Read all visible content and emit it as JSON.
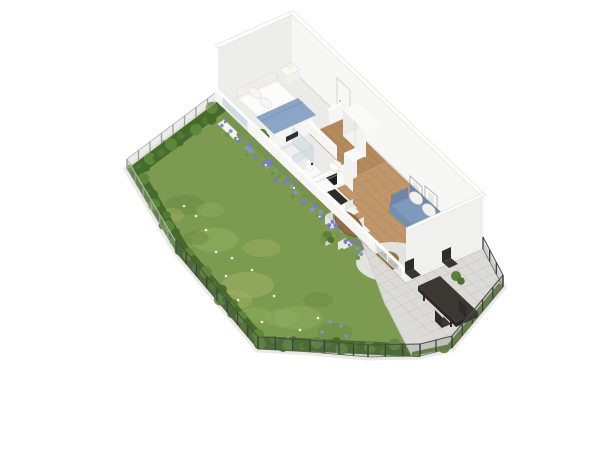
{
  "canvas": {
    "width": 600,
    "height": 450
  },
  "scene": {
    "description": "3D isometric floor plan render of a one-bedroom garden apartment with terrace",
    "areas": {
      "garden": {
        "items": [
          "lawn",
          "hedge",
          "wire-fence",
          "lavender-flowers",
          "daisies"
        ]
      },
      "bedroom": {
        "items": [
          "double-bed",
          "blue-blanket",
          "pillows",
          "nightstand",
          "plant",
          "window"
        ]
      },
      "hallway": {
        "items": [
          "entry-door",
          "wardrobe",
          "wood-floor"
        ]
      },
      "bathroom": {
        "items": [
          "shower",
          "vanity-sink",
          "toilet",
          "mirror"
        ]
      },
      "kitchen": {
        "items": [
          "l-shaped-counter",
          "oven",
          "cooktop",
          "tall-cabinet",
          "plant"
        ]
      },
      "living_room": {
        "items": [
          "round-dining-table",
          "four-chairs",
          "blue-sofa",
          "coffee-table",
          "rug",
          "two-wall-frames",
          "terrace-door"
        ]
      },
      "terrace": {
        "items": [
          "stone-tiles",
          "dark-dining-table",
          "four-chairs",
          "mesh-fence",
          "grass-strip"
        ]
      }
    },
    "counts": {
      "interior_chairs": 4,
      "terrace_chairs": 4,
      "wall_frames": 2,
      "pillows": 2
    }
  },
  "palette": {
    "bg": "#ffffff",
    "edging": "#e9e7e2",
    "edging2": "#f1efeb",
    "grass": "#7c9b50",
    "grassLight": "#8fae5f",
    "grassDark": "#6a8a41",
    "grassYellow": "#a3b264",
    "hedgeDark": "#466b2b",
    "hedgeMid": "#527a33",
    "hedgeLight": "#5f8a3c",
    "daisy": "#f6f6f2",
    "violet": "#8a8fd6",
    "lavender": "#7b79cf",
    "fencePostLight": "#9aa09b",
    "fenceRailLight": "#b8bdb8",
    "meshLight": "rgba(185,190,184,0.28)",
    "fencePostDark": "#3d423c",
    "fenceRailDark": "#4a4f48",
    "meshDark": "rgba(100,110,96,0.22)",
    "wallBright": "#f7f7f5",
    "wallTop": "#fdfdfc",
    "wallSide": "#ededeb",
    "wallNear": "#f5f5f3",
    "wallRight": "#f0f0ee",
    "wallStroke": "#e3e3df",
    "wallShadow": "rgba(90,90,85,0.12)",
    "innerShadow": "rgba(100,100,95,0.15)",
    "floorBedroom": "#ebebe9",
    "floorBath": "#e9eae9",
    "wood": "#b28a5c",
    "woodLine": "#9d7a4e",
    "parquet": "#c0976a",
    "doorWhite": "#f7f7f5",
    "doorStroke": "#d5d5d1",
    "glass": "#ccd6dc",
    "frame": "#fdfdfc",
    "frameStroke": "#b5b5b1",
    "frameInner": "#e8e8e4",
    "bedFrame": "#f7f7f4",
    "bedStroke": "#e2e2de",
    "mattress": "#fcfcfa",
    "headboard": "#efeeeb",
    "pillow": "#f6f6f2",
    "pillowStroke": "#e3e3de",
    "blanket": "#8ba5c6",
    "blanketLine": "#7b97bb",
    "furnWhite": "#f8f8f5",
    "furnFace": "#ededea",
    "furnSide": "#f1f1ee",
    "furnStroke": "#e4e4df",
    "wardrobeFront": "#f3f3f0",
    "wardrobeSide": "#eaeae7",
    "wardrobeTop": "#fafaf8",
    "lineGrey": "#dcdcd8",
    "counter": "#f9f9f7",
    "counterSide": "#ededea",
    "counterFront": "#f2f2ef",
    "black": "#1f1f1f",
    "cooktop": "#2b2b2b",
    "steel": "#6a6a6a",
    "mirror": "#2e2e2e",
    "showerGlass": "rgba(205,218,226,0.5)",
    "showerRim": "#cfd6da",
    "trayFill": "#eef0f0",
    "trayStroke": "#d7dada",
    "toiletWhite": "#fbfbf9",
    "tableWood": "#996f45",
    "tableWoodDark": "#7d5a36",
    "chairWhite": "#f3f2ee",
    "chairShade": "#e9e7e2",
    "chairStroke": "#deddd8",
    "rug": "#e2e2de",
    "sofaBack": "#6d87aa",
    "sofaSeat": "#7f99bc",
    "sofaFront": "#7390b3",
    "cushion": "#f2f1ed",
    "cushionStroke": "#e0dfda",
    "throw": "#e8e7e2",
    "plant1": "#5c7f3a",
    "plant2": "#6f9347",
    "plant3": "#4f7030",
    "pot": "#d0cec9",
    "accentYellow": "#d8c94f",
    "tile": "#dcdbd8",
    "tileStroke": "#cfcecb",
    "tileLine": "#c9c8c4",
    "terraceGrass": "#5a7a33",
    "tTable": "#3b3733",
    "tTableSide": "#2d2a26",
    "tChair": "#3a3632",
    "tChairDark": "#2f2b28",
    "planter": "#f4f4f2"
  }
}
